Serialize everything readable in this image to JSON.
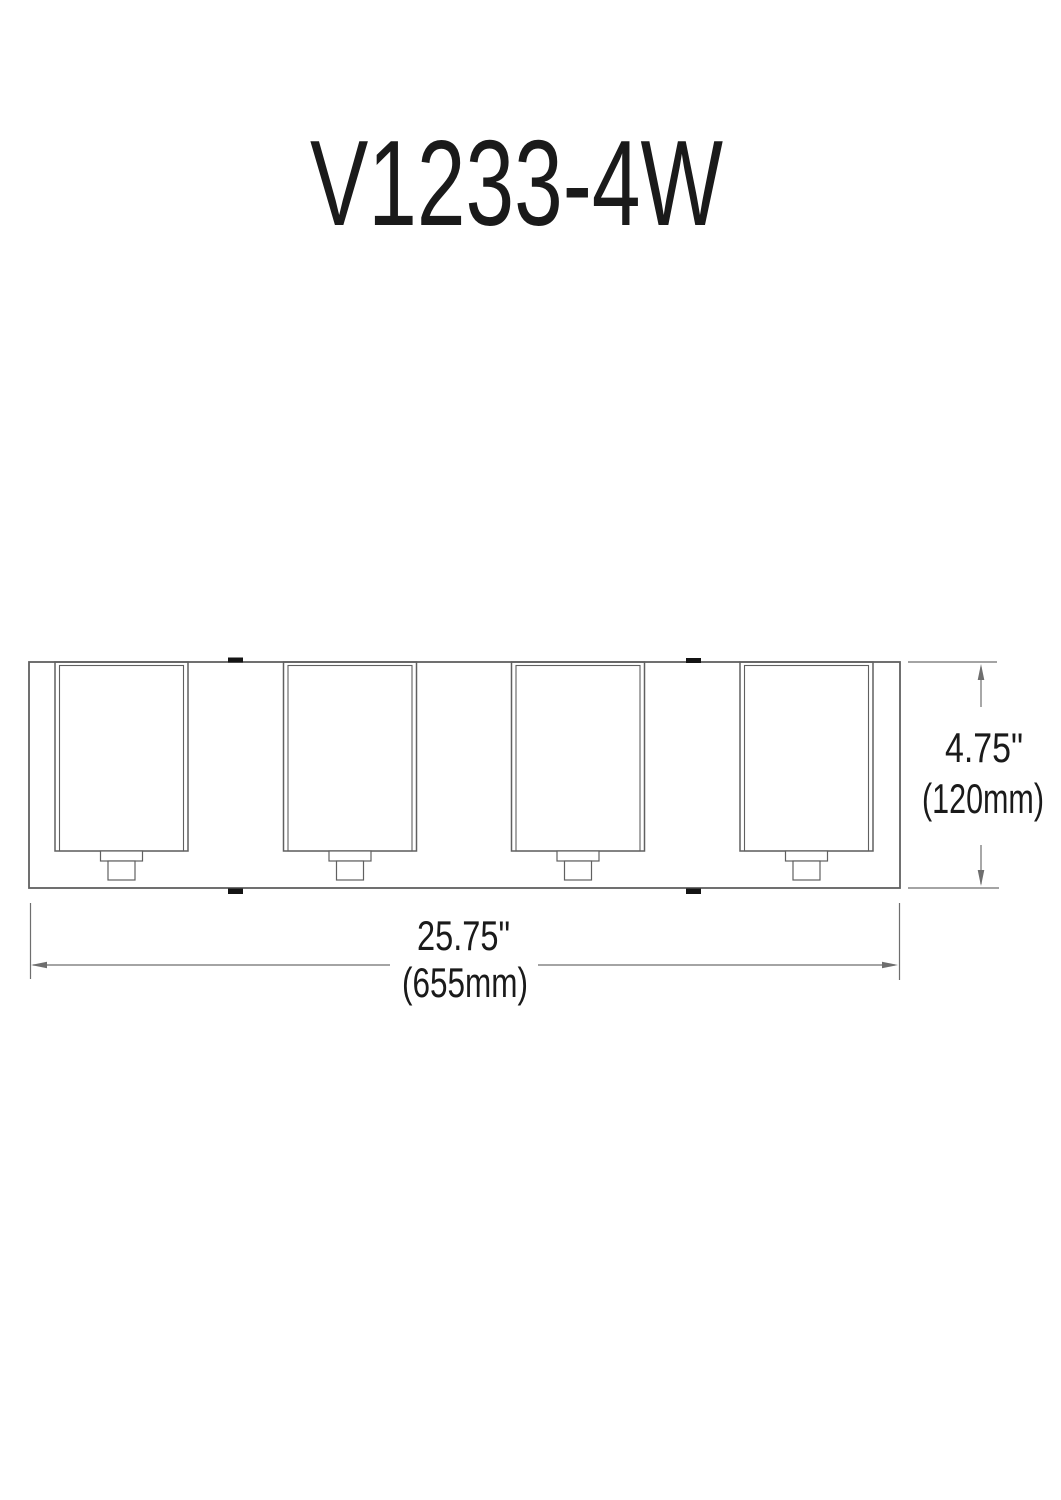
{
  "title": "V1233-4W",
  "dimensions": {
    "height_in": "4.75\"",
    "height_mm": "(120mm)",
    "width_in": "25.75\"",
    "width_mm": "(655mm)"
  },
  "colors": {
    "line": "#606060",
    "dim": "#6e6e6e",
    "text": "#1a1a1a",
    "tab": "#141414",
    "background": "#ffffff"
  }
}
